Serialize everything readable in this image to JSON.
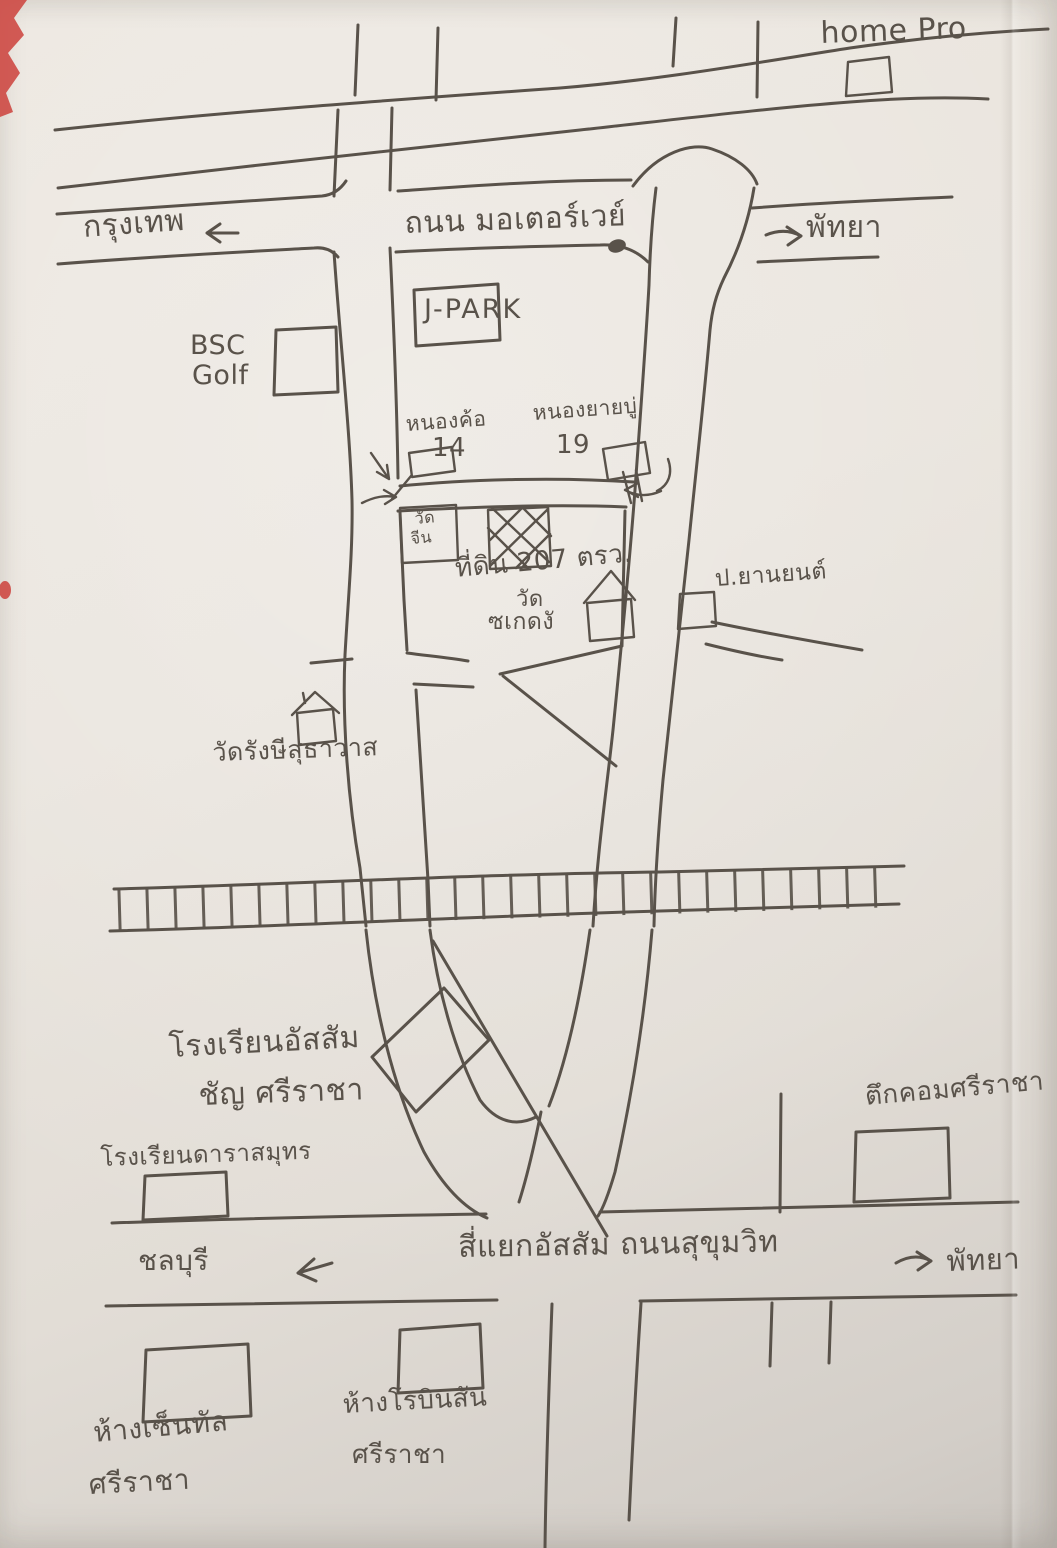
{
  "colors": {
    "ink": "#59524a",
    "paper": "#e8e3dc",
    "red_mark": "#cd4540"
  },
  "roads": {
    "motorway": "ถนน มอเตอร์เวย์",
    "sukhumvit_intersection": "สี่แยกอัสสัม  ถนนสุขุมวิท"
  },
  "directions": {
    "bangkok": "กรุงเทพ",
    "pattaya_top": "พัทยา",
    "pattaya_bottom": "พัทยา",
    "chonburi": "ชลบุรี"
  },
  "places": {
    "home_pro": "home Pro",
    "j_park": "J-PARK",
    "bsc_golf_line1": "BSC",
    "bsc_golf_line2": "Golf",
    "soi14_name": "หนองค้อ",
    "soi14_number": "14",
    "soi19_name": "หนองยายบู่",
    "soi19_number": "19",
    "wat_chin_line1": "วัด",
    "wat_chin_line2": "จีน",
    "land_plot": "ที่ดิน 207 ตรว.",
    "wat_sakedong_line1": "วัด",
    "wat_sakedong_line2": "ซเกดงั",
    "p_yanyon": "ป.ยานยนต์",
    "wat_rangsi": "วัดรังษีสุธาวาส",
    "assumption_line1": "โรงเรียนอัสสัม",
    "assumption_line2": "ชัญ ศรีราชา",
    "tukcom": "ตึกคอมศรีราชา",
    "darasamut": "โรงเรียนดาราสมุทร",
    "central_line1": "ห้างเซ็นทัล",
    "central_line2": "ศรีราชา",
    "robinson_line1": "ห้างโรบินสัน",
    "robinson_line2": "ศรีราชา"
  }
}
